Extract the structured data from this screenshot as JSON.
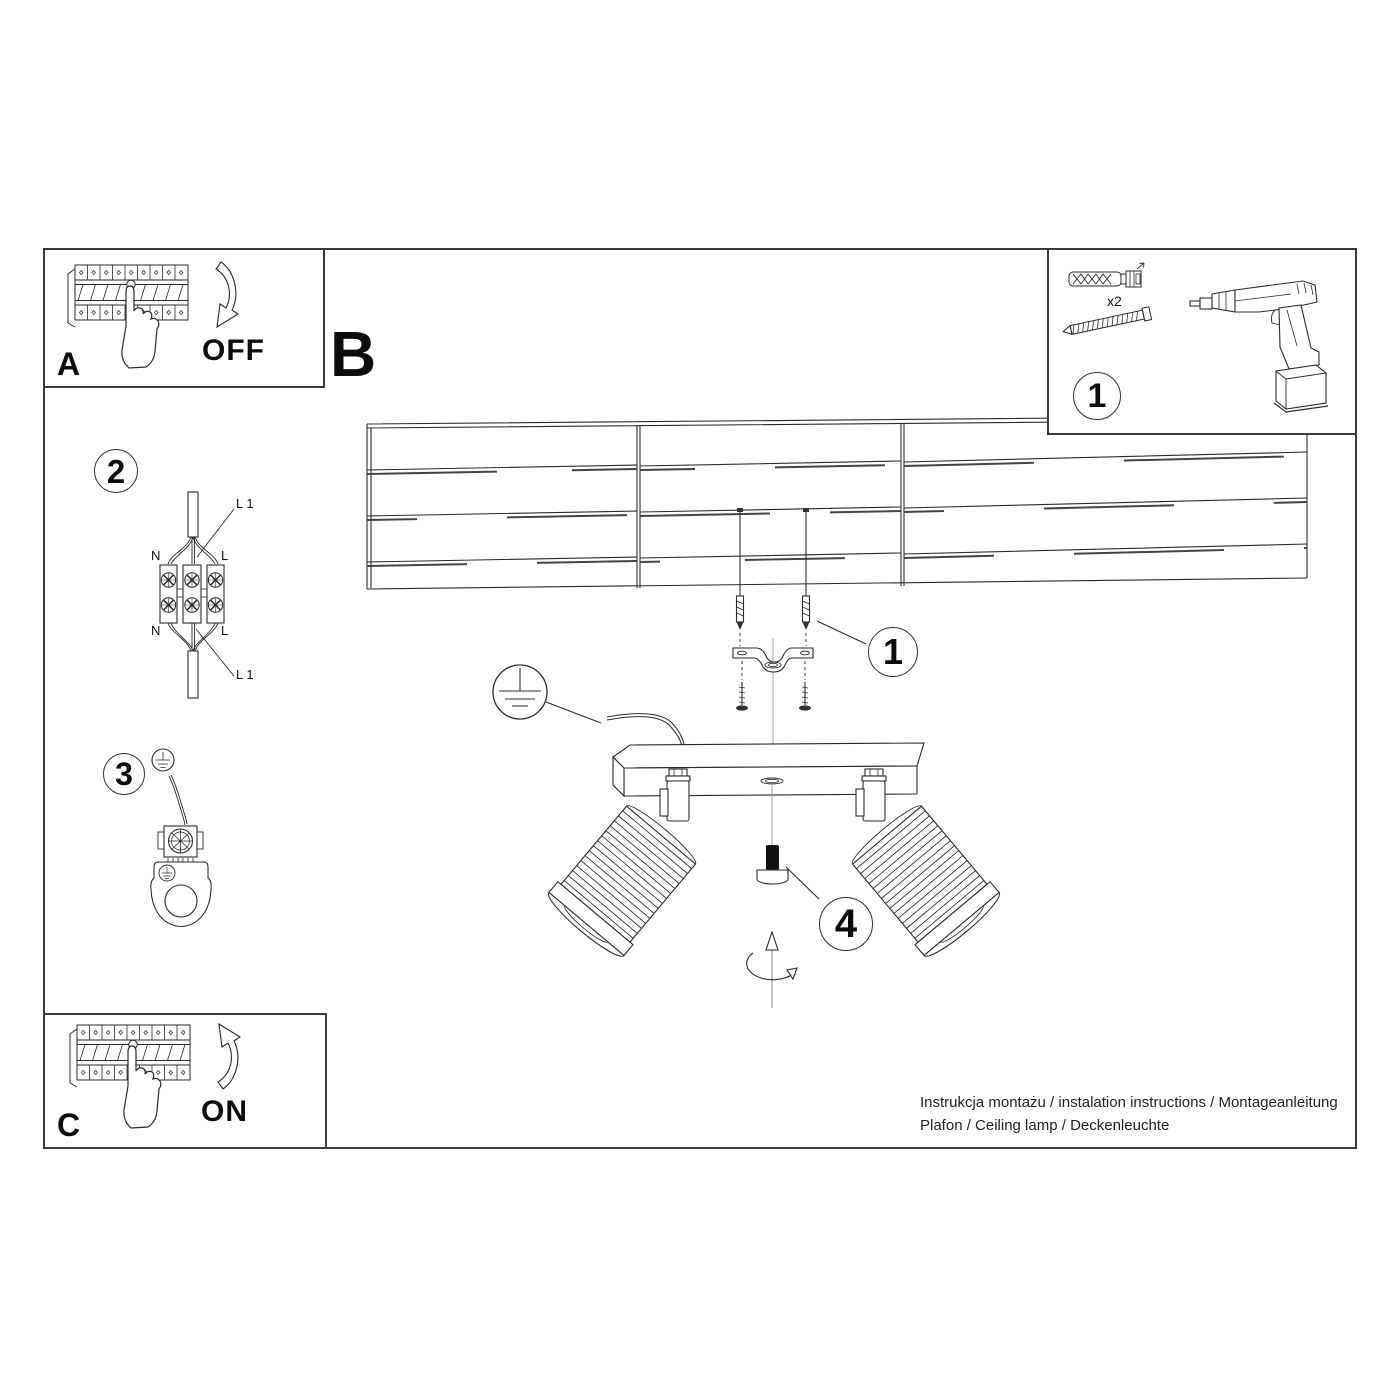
{
  "panels": {
    "a": {
      "letter": "A",
      "action_label": "OFF"
    },
    "b": {
      "letter": "B"
    },
    "c": {
      "letter": "C",
      "action_label": "ON"
    },
    "tools": {
      "step_number": "1",
      "screw_quantity": "x2"
    }
  },
  "callouts": {
    "mounting": "1",
    "wiring": "2",
    "grounding": "3",
    "adjustment": "4"
  },
  "wiring_diagram": {
    "l1_top": "L 1",
    "n_top": "N",
    "l_top": "L",
    "n_bottom": "N",
    "l_bottom": "L",
    "l1_bottom": "L 1"
  },
  "footer": {
    "line1": "Instrukcja montażu / instalation instructions / Montageanleitung",
    "line2": "Plafon / Ceiling lamp / Deckenleuchte"
  },
  "colors": {
    "line": "#2a2a2a",
    "background": "#ffffff",
    "frame": "#3a3a3a"
  },
  "diagram_elements": [
    "circuit-breaker-icon",
    "pressing-hand-icon",
    "curved-arrow-down-icon",
    "curved-arrow-up-icon",
    "wall-plug-icon",
    "mounting-screw-icon",
    "cordless-drill-icon",
    "ceiling-boards-icon",
    "ceiling-screw-icon",
    "mounting-bracket-icon",
    "ground-symbol-icon",
    "ground-wire-icon",
    "terminal-block-icon",
    "ground-terminal-icon",
    "lamp-base-icon",
    "lamp-shade-icon",
    "thumb-screw-icon",
    "rotation-arrow-icon"
  ]
}
